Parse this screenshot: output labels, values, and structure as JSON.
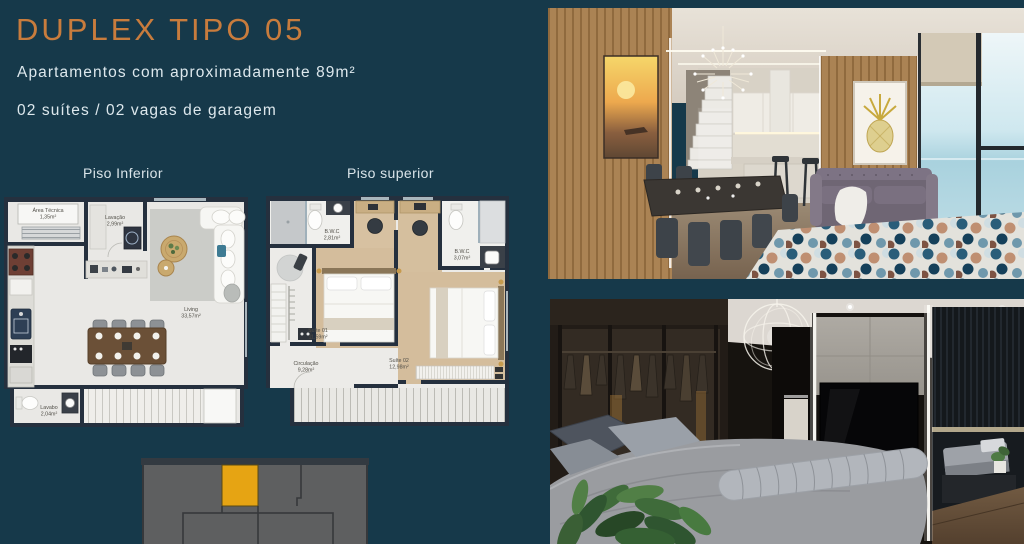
{
  "page": {
    "background_color": "#16394a",
    "accent_color": "#c87c3d"
  },
  "header": {
    "title": "DUPLEX TIPO 05",
    "subtitle_area": "Apartamentos com aproximadamente 89m²",
    "subtitle_features": "02 suítes / 02 vagas de garagem"
  },
  "plans": {
    "lower": {
      "label": "Piso Inferior",
      "rooms": [
        {
          "name": "Área Técnica",
          "area": "1,35m²"
        },
        {
          "name": "Lavação",
          "area": "2,99m²"
        },
        {
          "name": "Living",
          "area": "33,57m²"
        },
        {
          "name": "Lavabo",
          "area": "2,04m²"
        }
      ]
    },
    "upper": {
      "label": "Piso superior",
      "rooms": [
        {
          "name": "B.W.C",
          "area": "2,81m²"
        },
        {
          "name": "B.W.C",
          "area": "3,07m²"
        },
        {
          "name": "Suíte 01",
          "area": "11,59m²"
        },
        {
          "name": "Suíte 02",
          "area": "12,98m²"
        },
        {
          "name": "Circulação",
          "area": "9,28m²"
        }
      ]
    }
  },
  "keyplan": {
    "body_color": "#5e5f60",
    "highlight_color": "#e6a413"
  }
}
